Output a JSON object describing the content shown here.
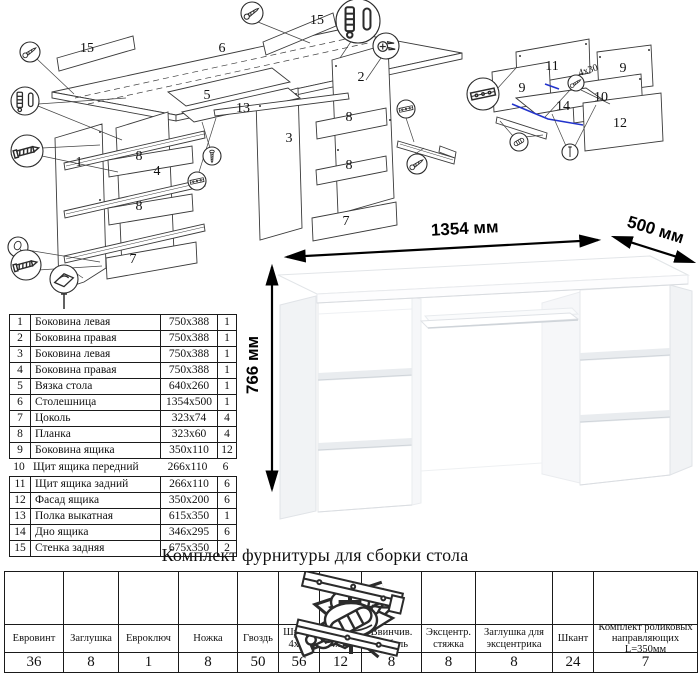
{
  "sheet": {
    "kind": "furniture assembly instruction",
    "colors": {
      "ink": "#1a1a1a",
      "accent_blue": "#2233cc",
      "desk_shade": "#f1f3f5"
    }
  },
  "dimensions": {
    "width": "1354 мм",
    "depth": "500 мм",
    "height": "766 мм"
  },
  "diagram_labels": {
    "main": [
      {
        "text": "15",
        "x": 87,
        "y": 52
      },
      {
        "text": "6",
        "x": 222,
        "y": 52
      },
      {
        "text": "15",
        "x": 317,
        "y": 24
      },
      {
        "text": "5",
        "x": 207,
        "y": 99
      },
      {
        "text": "13",
        "x": 243,
        "y": 112
      },
      {
        "text": "3",
        "x": 289,
        "y": 142
      },
      {
        "text": "2",
        "x": 361,
        "y": 81
      },
      {
        "text": "1",
        "x": 79,
        "y": 166
      },
      {
        "text": "8",
        "x": 139,
        "y": 160
      },
      {
        "text": "4",
        "x": 157,
        "y": 175
      },
      {
        "text": "8",
        "x": 139,
        "y": 210
      },
      {
        "text": "7",
        "x": 133,
        "y": 263
      },
      {
        "text": "8",
        "x": 349,
        "y": 121
      },
      {
        "text": "8",
        "x": 349,
        "y": 169
      },
      {
        "text": "7",
        "x": 346,
        "y": 225
      }
    ],
    "drawer": [
      {
        "text": "11",
        "x": 552,
        "y": 70
      },
      {
        "text": "9",
        "x": 623,
        "y": 72
      },
      {
        "text": "9",
        "x": 522,
        "y": 92
      },
      {
        "text": "4х30",
        "x": 589,
        "y": 73,
        "rot": -18,
        "small": true
      },
      {
        "text": "10",
        "x": 601,
        "y": 101
      },
      {
        "text": "14",
        "x": 563,
        "y": 110
      },
      {
        "text": "12",
        "x": 620,
        "y": 127
      }
    ]
  },
  "callouts": {
    "main": [
      {
        "icon": "screw-icon",
        "x": 252,
        "y": 13,
        "r": 11
      },
      {
        "icon": "pin-pair-icon",
        "x": 358,
        "y": 21,
        "r": 22
      },
      {
        "icon": "cam-screws-icon",
        "x": 386,
        "y": 46,
        "r": 13
      },
      {
        "icon": "screw-icon",
        "x": 30,
        "y": 52,
        "r": 10
      },
      {
        "icon": "pin-pair-icon",
        "x": 25,
        "y": 101,
        "r": 14
      },
      {
        "icon": "euro-screw-icon",
        "x": 27,
        "y": 151,
        "r": 16
      },
      {
        "icon": "cap-icon",
        "x": 18,
        "y": 247,
        "r": 10
      },
      {
        "icon": "euro-screw-icon",
        "x": 26,
        "y": 265,
        "r": 15
      },
      {
        "icon": "foot-icon",
        "x": 64,
        "y": 279,
        "r": 14
      },
      {
        "icon": "screw-vert-icon",
        "x": 212,
        "y": 156,
        "r": 9
      },
      {
        "icon": "rail-icon",
        "x": 197,
        "y": 181,
        "r": 9
      },
      {
        "icon": "rail-icon",
        "x": 406,
        "y": 109,
        "r": 9
      },
      {
        "icon": "screw-icon",
        "x": 417,
        "y": 164,
        "r": 10
      }
    ],
    "drawer": [
      {
        "icon": "rail-icon",
        "x": 483,
        "y": 94,
        "r": 16
      },
      {
        "icon": "screw-icon",
        "x": 576,
        "y": 83,
        "r": 8
      },
      {
        "icon": "shkant-icon",
        "x": 519,
        "y": 142,
        "r": 9
      },
      {
        "icon": "nail-icon",
        "x": 570,
        "y": 152,
        "r": 8
      }
    ]
  },
  "parts_table": {
    "columns": [
      "№",
      "Наименование",
      "Размер",
      "Кол-во"
    ],
    "borderless_row_number": 10,
    "rows": [
      {
        "num": "1",
        "name": "Боковина левая",
        "size": "750х388",
        "qty": "1"
      },
      {
        "num": "2",
        "name": "Боковина правая",
        "size": "750х388",
        "qty": "1"
      },
      {
        "num": "3",
        "name": "Боковина левая",
        "size": "750х388",
        "qty": "1"
      },
      {
        "num": "4",
        "name": "Боковина правая",
        "size": "750х388",
        "qty": "1"
      },
      {
        "num": "5",
        "name": "Вязка стола",
        "size": "640х260",
        "qty": "1"
      },
      {
        "num": "6",
        "name": "Столешница",
        "size": "1354х500",
        "qty": "1"
      },
      {
        "num": "7",
        "name": "Цоколь",
        "size": "323х74",
        "qty": "4"
      },
      {
        "num": "8",
        "name": "Планка",
        "size": "323х60",
        "qty": "4"
      },
      {
        "num": "9",
        "name": "Боковина ящика",
        "size": "350х110",
        "qty": "12"
      },
      {
        "num": "10",
        "name": "Щит ящика передний",
        "size": "266х110",
        "qty": "6"
      },
      {
        "num": "11",
        "name": "Щит ящика задний",
        "size": "266х110",
        "qty": "6"
      },
      {
        "num": "12",
        "name": "Фасад ящика",
        "size": "350х200",
        "qty": "6"
      },
      {
        "num": "13",
        "name": "Полка выкатная",
        "size": "615х350",
        "qty": "1"
      },
      {
        "num": "14",
        "name": "Дно ящика",
        "size": "346х295",
        "qty": "6"
      },
      {
        "num": "15",
        "name": "Стенка задняя",
        "size": "675х350",
        "qty": "2"
      }
    ]
  },
  "hardware": {
    "title": "Комплект фурнитуры для сборки стола",
    "items": [
      {
        "icon": "euro-screw-icon",
        "name": "Евровинт",
        "qty": "36",
        "w": 58
      },
      {
        "icon": "cap-icon",
        "name": "Заглушка",
        "qty": "8",
        "w": 55
      },
      {
        "icon": "hex-key-icon",
        "name": "Евроключ",
        "qty": "1",
        "w": 60
      },
      {
        "icon": "foot-icon",
        "name": "Ножка",
        "qty": "8",
        "w": 59
      },
      {
        "icon": "nail-icon",
        "name": "Гвоздь",
        "qty": "50",
        "w": 41
      },
      {
        "icon": "screw-short-icon",
        "name": "Шуруп 4х16",
        "qty": "56",
        "w": 41
      },
      {
        "icon": "screw-long-icon",
        "name": "Шуруп 4х30",
        "qty": "12",
        "w": 42
      },
      {
        "icon": "dowel-screw-icon",
        "name": "Ввинчив. дюбель",
        "qty": "8",
        "w": 60
      },
      {
        "icon": "cam-lock-icon",
        "name": "Эксцентр. стяжка",
        "qty": "8",
        "w": 54
      },
      {
        "icon": "cam-cap-icon",
        "name": "Заглушка для эксцентрика",
        "qty": "8",
        "w": 77
      },
      {
        "icon": "shkant-icon",
        "name": "Шкант",
        "qty": "24",
        "w": 41
      },
      {
        "icon": "slide-rail-icon",
        "name": "Комплект роликовых направляющих L=350мм",
        "qty": "7",
        "w": 104
      }
    ]
  }
}
